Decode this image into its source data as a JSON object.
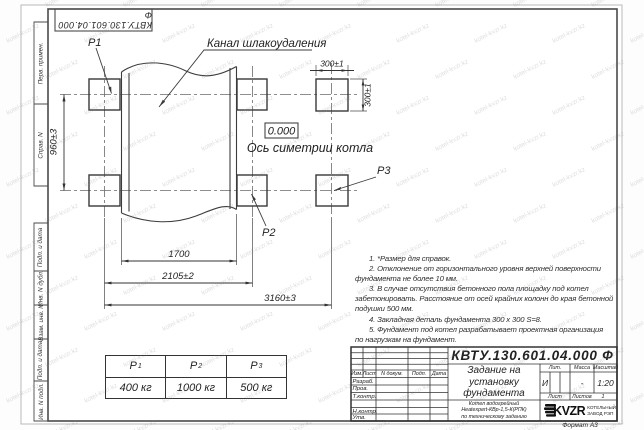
{
  "sheet": {
    "watermark": "kotel-kvzr.kz",
    "format_label": "Формат А3"
  },
  "corner_stamp": {
    "doc_number": "КВТУ.130.601.04.000 Ф"
  },
  "margin_stamps": {
    "perv_primen": "Перв. примен.",
    "sprav_n": "Справ. N",
    "podp_data_1": "Подп. и дата",
    "inv_dubl": "Инв. N дубл.",
    "vzam_inv": "Взам. инв. N",
    "podp_data_2": "Подп. и дата",
    "inv_podl": "Инв. N подл."
  },
  "drawing": {
    "channel_label": "Канал шлакоудаления",
    "p1": "P1",
    "p2": "P2",
    "p3": "P3",
    "elevation": "0.000",
    "axis_label": "Ось симетрии котла",
    "dim_960": "960±3",
    "dim_300_w": "300±1",
    "dim_300_h": "300±1",
    "dim_1700": "1700",
    "dim_2105": "2105±2",
    "dim_3160": "3160±3"
  },
  "notes": {
    "lines": [
      "1. *Размер для справок.",
      "2. Отклонение от горизонтального уровня верхней поверхности",
      "фундамента не более 10 мм.",
      "3. В случае отсутствия бетонного пола площадку под котел",
      "забетонировать. Расстояние от осей крайних колонн до края бетонной",
      "подушки 500 мм.",
      "4. Закладная деталь фундамента  300 х 300 S=8.",
      "5. Фундамент под котел разрабатывает проектная организация",
      "по нагрузкам на фундамент."
    ]
  },
  "load_table": {
    "headers": [
      {
        "sym": "P",
        "sub": "1"
      },
      {
        "sym": "P",
        "sub": "2"
      },
      {
        "sym": "P",
        "sub": "3"
      }
    ],
    "values": [
      "400 кг",
      "1000 кг",
      "500 кг"
    ]
  },
  "title_block": {
    "doc_number": "КВТУ.130.601.04.000  Ф",
    "title_line1": "Задание на",
    "title_line2": "установку",
    "title_line3": "фундамента",
    "col_izm": "Изм.",
    "col_list": "Лист",
    "col_doc": "N докум.",
    "col_sign": "Подп.",
    "col_date": "Дата",
    "row_razrab": "Разраб.",
    "row_prov": "Пров.",
    "row_tkontr": "Т.контр.",
    "row_nkontr": "Н.контр.",
    "row_utv": "Утв.",
    "lit_label": "Лит.",
    "lit_value": "И",
    "mass_label": "Масса",
    "mass_value": "-",
    "scale_label": "Масштаб",
    "scale_value": "1:20",
    "list_label": "Лист",
    "listov_label": "Листов",
    "listov_value": "1",
    "product_line1": "Котел водогрейный",
    "product_line2": "Heatexpert-КВр-1,5-К(РПК)",
    "product_line3": "по техническому заданию",
    "logo_text": "KVZR",
    "company_line1": "КОТЕЛЬНЫЙ",
    "company_line2": "ЗАВОД РЭП"
  }
}
